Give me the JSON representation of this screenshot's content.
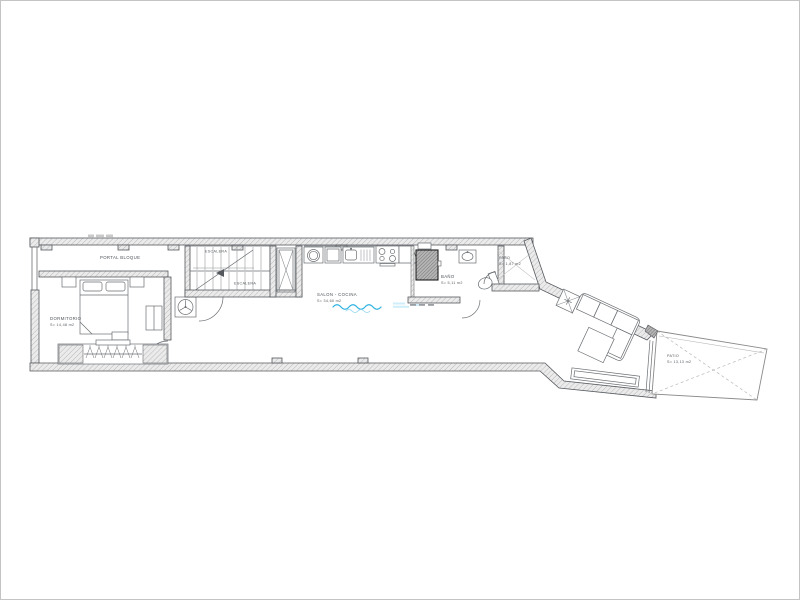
{
  "labels": {
    "portal": "PORTAL BLOQUE"
  },
  "rooms": {
    "dormitorio": {
      "name": "DORMITORIO",
      "area": "S= 14,48 m2"
    },
    "escalera": {
      "upper": "ESCALERA",
      "lower": "ESCALERA"
    },
    "salon_cocina": {
      "name": "SALON - COCINA",
      "area": "S= 34,60 m2"
    },
    "bano": {
      "name": "BAÑO",
      "area": "S= 5,11 m2"
    },
    "paso": {
      "name": "PASO",
      "area": "S= 1,87 m2"
    },
    "patio": {
      "name": "PATIO",
      "area": "S= 13,13 m2"
    }
  },
  "colors": {
    "drawing_line": "#55595e",
    "wall_fill": "#ebebeb",
    "hatch_line": "#a3a3a3",
    "dark_fixture": "#9a9a9a",
    "water_blue": "#2fb3e2",
    "label_text": "#4d5257",
    "page_border": "#c4c4c4"
  }
}
